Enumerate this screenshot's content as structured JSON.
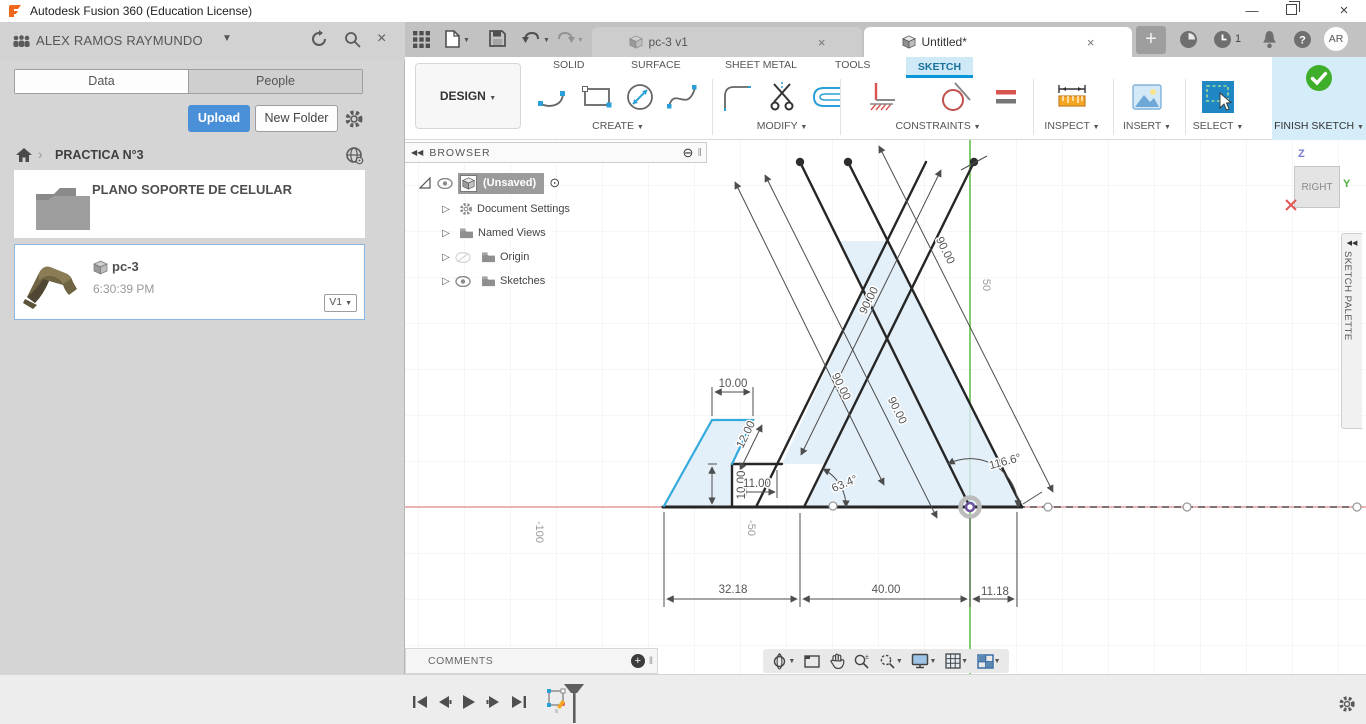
{
  "window": {
    "title": "Autodesk Fusion 360 (Education License)"
  },
  "left_panel": {
    "user": "ALEX RAMOS RAYMUNDO",
    "tab_data": "Data",
    "tab_people": "People",
    "upload": "Upload",
    "new_folder": "New Folder",
    "project": "PRACTICA N°3",
    "folder_name": "PLANO SOPORTE DE CELULAR",
    "item_name": "pc-3",
    "item_time": "6:30:39 PM",
    "item_version": "V1"
  },
  "docbar": {
    "tab1": "pc-3 v1",
    "tab2": "Untitled*",
    "notifications": "1",
    "avatar": "AR"
  },
  "ribbon": {
    "design_label": "DESIGN",
    "tab_solid": "SOLID",
    "tab_surface": "SURFACE",
    "tab_sheetmetal": "SHEET METAL",
    "tab_tools": "TOOLS",
    "tab_sketch": "SKETCH",
    "g_create": "CREATE",
    "g_modify": "MODIFY",
    "g_constraints": "CONSTRAINTS",
    "g_inspect": "INSPECT",
    "g_insert": "INSERT",
    "g_select": "SELECT",
    "finish": "FINISH SKETCH"
  },
  "browser": {
    "title": "BROWSER",
    "root": "(Unsaved)",
    "n1": "Document Settings",
    "n2": "Named Views",
    "n3": "Origin",
    "n4": "Sketches"
  },
  "viewcube": {
    "face": "RIGHT",
    "axis_z": "Z",
    "axis_y": "Y"
  },
  "palette": {
    "title": "SKETCH PALETTE"
  },
  "comments": {
    "title": "COMMENTS"
  },
  "sketch": {
    "dim_top_width": "10.00",
    "dim_slant": "12.00",
    "dim_step_height": "10.00",
    "dim_step_width": "11.00",
    "dim_leg_a": "90.00",
    "dim_leg_b": "90.00",
    "dim_leg_c": "90.00",
    "dim_leg_d": "90.00",
    "angle_left": "63.4°",
    "angle_right": "116.6°",
    "dim_bottom_left": "32.18",
    "dim_bottom_mid": "40.00",
    "dim_bottom_right": "11.18",
    "axis_y_50": "50",
    "axis_x_m50": "-50",
    "axis_x_m100": "-100"
  },
  "colors": {
    "accent_blue": "#0696d7",
    "upload_blue": "#4a90d9",
    "finish_green": "#3fae2a",
    "axis_red": "#e39b9b",
    "axis_green": "#66bf4d",
    "selected_cyan": "#35aadc",
    "fill_blue": "#ddecf8"
  }
}
